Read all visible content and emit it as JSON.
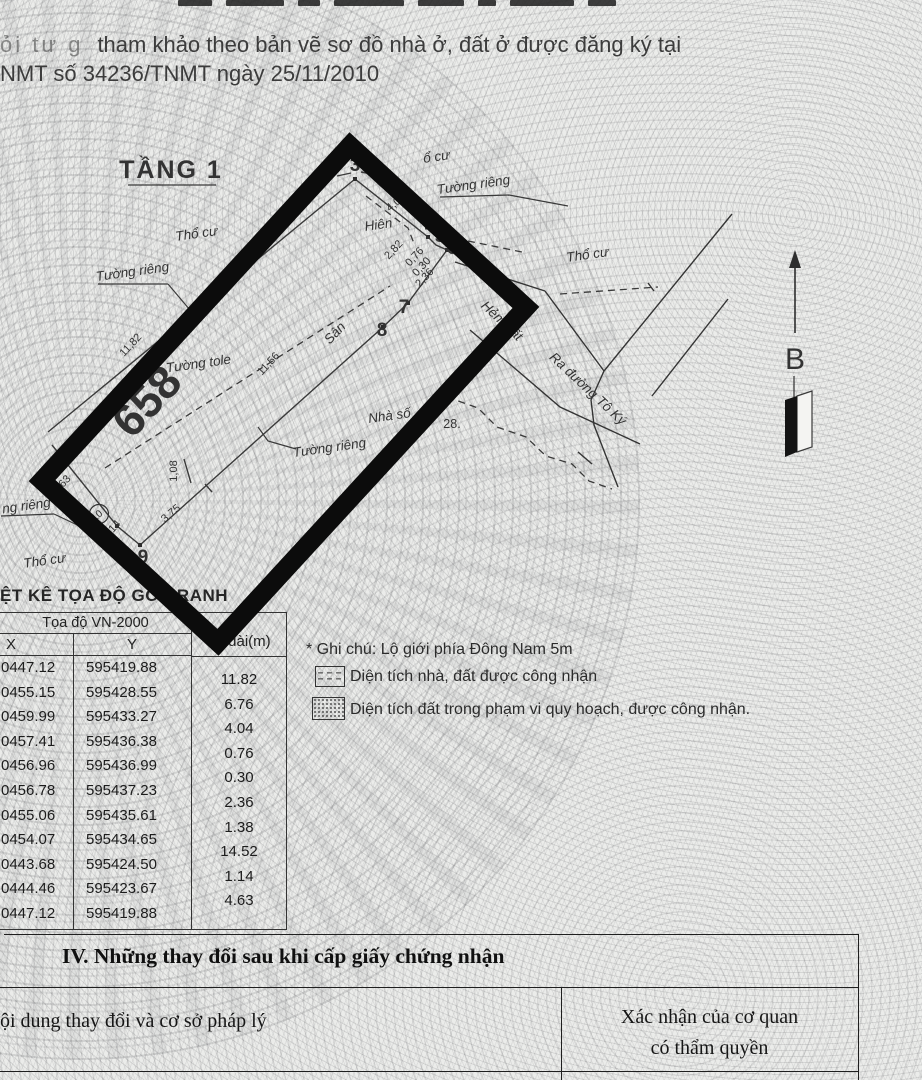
{
  "top": {
    "line1_prefix": "ỏi tư g",
    "line1": "tham khảo theo bản vẽ sơ đồ nhà ở, đất ở được đăng ký tại",
    "line2": "NMT số 34236/TNMT ngày 25/11/2010"
  },
  "map": {
    "floor_title": "TẦNG 1",
    "parcel_number": "658",
    "north_label": "B",
    "labels": {
      "tho_cu": "Thổ cư",
      "tho_cu_partial": "ổ cư",
      "tuong_rieng": "Tường riêng",
      "tuong_rieng_cut": "ng riêng",
      "tuong_tole": "Tường tole",
      "hem_dat": "Hẻm đất",
      "ra_duong_to_ky": "Ra đường Tô Ký",
      "hien": "Hiên",
      "san": "Sân",
      "nha_so": "Nhà số",
      "nha_so_value": "28."
    },
    "vertices": {
      "v3": "3",
      "v4": "4",
      "v5": "5",
      "v6": "6",
      "v7": "7",
      "v8": "8",
      "v9": "9",
      "v10": "10"
    },
    "dims": {
      "d1182": "11,82",
      "d676": "6,76",
      "d404": "4,04",
      "d282": "2,82",
      "d076": "0,76",
      "d030": "0,30",
      "d236": "2,36",
      "d1156": "11,56",
      "d108": "1,08",
      "d375": "3,75",
      "d114": "1,14",
      "d463": "4,63"
    }
  },
  "coord_table": {
    "title": "ỆT KÊ TỌA ĐỘ GÓC RANH",
    "group_header": "Tọa độ VN-2000",
    "col_x": "X",
    "col_y": "Y",
    "col_length": "ều dài(m)",
    "rows": [
      {
        "x": "0447.12",
        "y": "595419.88"
      },
      {
        "x": "0455.15",
        "y": "595428.55"
      },
      {
        "x": "0459.99",
        "y": "595433.27"
      },
      {
        "x": "0457.41",
        "y": "595436.38"
      },
      {
        "x": "0456.96",
        "y": "595436.99"
      },
      {
        "x": "0456.78",
        "y": "595437.23"
      },
      {
        "x": "0455.06",
        "y": "595435.61"
      },
      {
        "x": "0454.07",
        "y": "595434.65"
      },
      {
        "x": "0443.68",
        "y": "595424.50"
      },
      {
        "x": "0444.46",
        "y": "595423.67"
      },
      {
        "x": "0447.12",
        "y": "595419.88"
      }
    ],
    "lengths": [
      "11.82",
      "6.76",
      "4.04",
      "0.76",
      "0.30",
      "2.36",
      "1.38",
      "14.52",
      "1.14",
      "4.63"
    ]
  },
  "notes": {
    "ghi_chu": "* Ghi chú: Lộ giới phía Đông Nam 5m",
    "legend_1": "Diện tích nhà, đất được công nhận",
    "legend_2": "Diện tích đất trong phạm vi quy hoạch, được công nhận."
  },
  "section_iv": {
    "title": "IV. Những thay đổi sau khi cấp giấy chứng nhận",
    "col_content": "ội dung thay đổi và cơ sở pháp lý",
    "col_confirm_line1": "Xác nhận của cơ quan",
    "col_confirm_line2": "có thẩm quyền"
  }
}
